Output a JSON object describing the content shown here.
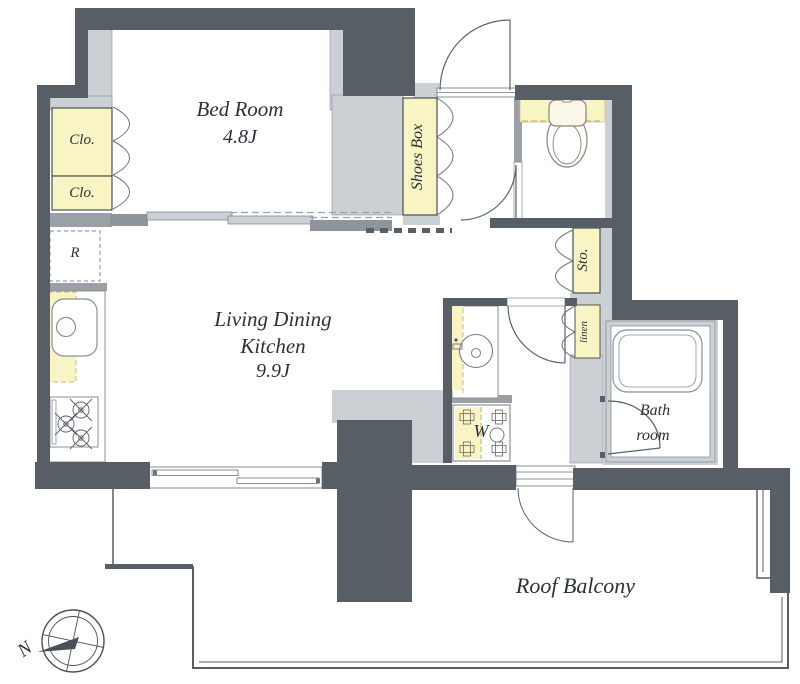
{
  "rooms": {
    "bedroom": {
      "name": "Bed Room",
      "size": "4.8J"
    },
    "ldk": {
      "line1": "Living Dining",
      "line2": "Kitchen",
      "size": "9.9J"
    },
    "bathroom": {
      "line1": "Bath",
      "line2": "room"
    },
    "balcony": {
      "name": "Roof Balcony"
    }
  },
  "storage": {
    "closet_upper": "Clo.",
    "closet_lower": "Clo.",
    "shoes_box": "Shoes Box",
    "storage": "Sto.",
    "linen": "linen"
  },
  "fixtures": {
    "washer": "W",
    "refrigerator": "R"
  },
  "compass": {
    "north_label": "N"
  },
  "colors": {
    "wall": "#575e66",
    "wall_light": "#cbd0d4",
    "highlight": "#f8f4c4"
  }
}
